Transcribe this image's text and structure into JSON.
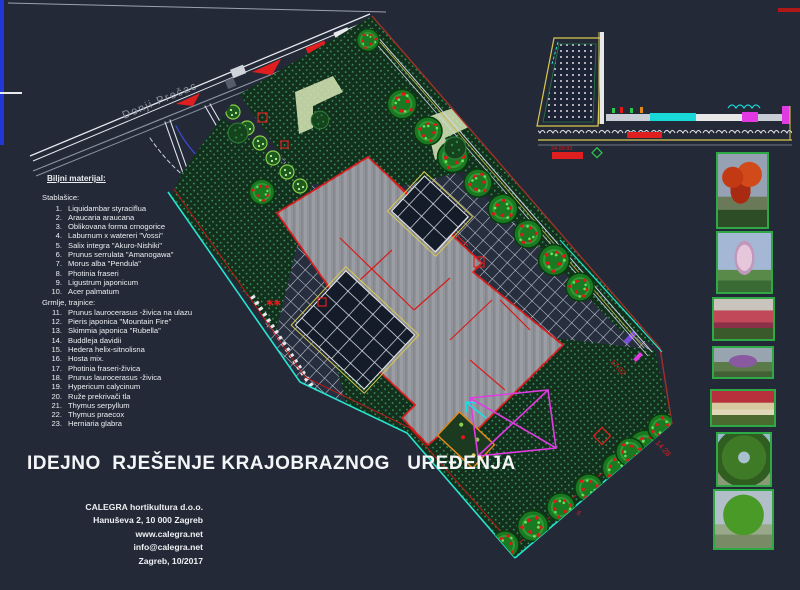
{
  "window": {
    "background": "#232936",
    "type": "CAD landscape plan drawing"
  },
  "street": {
    "label": "Donji Prečac"
  },
  "plant_list": {
    "header": "Biljni materijal:",
    "trees_header": "Stablašice:",
    "trees": [
      {
        "num": "1.",
        "name": "Liquidambar styraciflua"
      },
      {
        "num": "2.",
        "name": "Araucaria araucana"
      },
      {
        "num": "3.",
        "name": "Oblikovana forma crnogorice"
      },
      {
        "num": "4.",
        "name": "Laburnum x watereri \"Vossi\""
      },
      {
        "num": "5.",
        "name": "Salix integra \"Akuro-Nishiki\""
      },
      {
        "num": "6.",
        "name": "Prunus serrulata \"Amanogawa\""
      },
      {
        "num": "7.",
        "name": "Morus alba \"Pendula\""
      },
      {
        "num": "8.",
        "name": "Photinia fraseri"
      },
      {
        "num": "9.",
        "name": "Ligustrum japonicum"
      },
      {
        "num": "10.",
        "name": "Acer palmatum"
      }
    ],
    "shrubs_header": "Grmlje, trajnice:",
    "shrubs": [
      {
        "num": "11.",
        "name": "Prunus laurocerasus -živica na ulazu"
      },
      {
        "num": "12.",
        "name": "Pieris japonica \"Mountain Fire\""
      },
      {
        "num": "13.",
        "name": "Skimmia japonica \"Rubella\""
      },
      {
        "num": "14.",
        "name": "Buddleja davidii"
      },
      {
        "num": "15.",
        "name": "Hedera helix-sitnolisna"
      },
      {
        "num": "16.",
        "name": "Hosta mix."
      },
      {
        "num": "17.",
        "name": "Photinia fraseri-živica"
      },
      {
        "num": "18.",
        "name": "Prunus laurocerasus -živica"
      },
      {
        "num": "19.",
        "name": "Hypericum calycinum"
      },
      {
        "num": "20.",
        "name": "Ruže prekrivači tla"
      },
      {
        "num": "21.",
        "name": "Thymus serpyllum"
      },
      {
        "num": "22.",
        "name": "Thymus praecox"
      },
      {
        "num": "23.",
        "name": "Herniaria glabra"
      }
    ]
  },
  "title": "IDEJNO  RJEŠENJE KRAJOBRAZNOG   UREĐENJA",
  "company": {
    "name": "CALEGRA hortikultura d.o.o.",
    "address": "Hanuševa 2, 10 000 Zagreb",
    "website": "www.calegra.net",
    "email": "info@calegra.net",
    "place_date": "Zagreb, 10/2017"
  },
  "dimensions": {
    "edge_ne": "17.02",
    "edge_se": "14.28",
    "lot_mark": "6.",
    "section_scale": "24.99.93"
  },
  "photos": [
    {
      "name": "red-autumn-tree-photo"
    },
    {
      "name": "pink-blossom-columnar-tree-photo"
    },
    {
      "name": "red-photinia-hedge-photo"
    },
    {
      "name": "purple-flowering-shrub-photo"
    },
    {
      "name": "rose-groundcover-bed-photo"
    },
    {
      "name": "green-arch-pergola-tree-photo"
    },
    {
      "name": "weeping-green-tree-photo"
    }
  ],
  "colors": {
    "background": "#232936",
    "red": "#df1f1f",
    "boundary_cyan": "#27e3cf",
    "magenta": "#e23ae2",
    "yellow": "#d9c94f",
    "grid_line": "#c6ccd8",
    "building_gray": "#8f9298",
    "lawn_green": "#12301c",
    "tree_green": "#1a7a22",
    "photinia_red": "#e01818",
    "road_line": "#9aa2b2",
    "frame_blue": "#2336d8"
  }
}
